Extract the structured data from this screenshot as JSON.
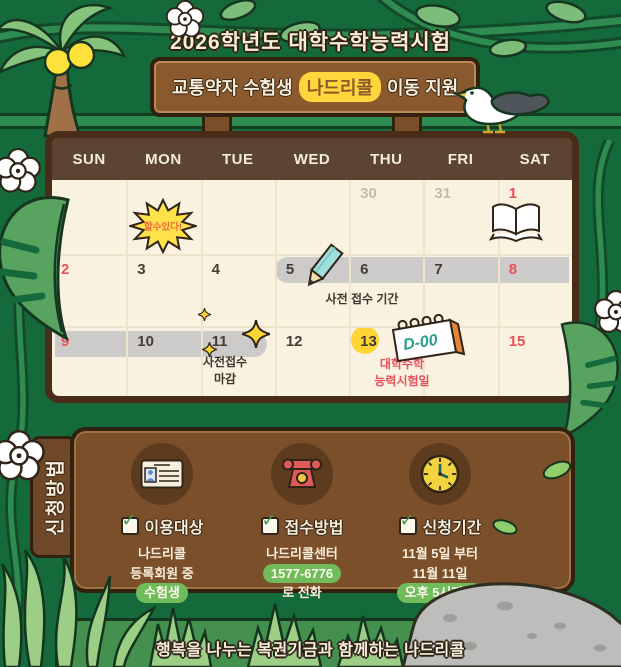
{
  "colors": {
    "background": "#156a3b",
    "sign_brown": "#8a5a2e",
    "frame_brown": "#4a2d18",
    "header_brown": "#5b4431",
    "calendar_cream": "#f9f2e0",
    "highlight_yellow": "#ffd63c",
    "date_red": "#e8505b",
    "date_gray": "#c3bcac",
    "band_gray": "#cccbc9",
    "panel_brown": "#7b4f29",
    "pill_green": "#70bc5a",
    "cream_text": "#f7eedd"
  },
  "header": {
    "title": "2026학년도 대학수학능력시험",
    "sign_pre": "교통약자 수험생",
    "sign_highlight": "나드리콜",
    "sign_post": "이동 지원"
  },
  "calendar": {
    "day_headers": [
      "SUN",
      "MON",
      "TUE",
      "WED",
      "THU",
      "FRI",
      "SAT"
    ],
    "weeks": [
      [
        "",
        "",
        "",
        "",
        "30",
        "31",
        "1"
      ],
      [
        "2",
        "3",
        "4",
        "5",
        "6",
        "7",
        "8"
      ],
      [
        "9",
        "10",
        "11",
        "12",
        "13",
        "",
        "15"
      ]
    ],
    "notes": {
      "cheer": "할수있다!",
      "pre_period": "사전 접수 기간",
      "pre_deadline_line1": "사전접수",
      "pre_deadline_line2": "마감",
      "exam_line1": "대학수학",
      "exam_line2": "능력시험일",
      "dday": "D-00"
    }
  },
  "info_panel": {
    "tab": "신청방법",
    "columns": [
      {
        "icon": "id-card-icon",
        "title": "이용대상",
        "line1": "나드리콜",
        "line2": "등록회원 중",
        "pill": "수험생"
      },
      {
        "icon": "phone-icon",
        "title": "접수방법",
        "line1": "나드리콜센터",
        "pill": "1577-6776",
        "line2": "로 전화"
      },
      {
        "icon": "clock-icon",
        "title": "신청기간",
        "line1": "11월 5일 부터",
        "line2": "11월 11일",
        "pill": "오후 5시까지"
      }
    ]
  },
  "footer": {
    "text": "행복을 나누는 복권기금과 함께하는 나드리콜"
  }
}
